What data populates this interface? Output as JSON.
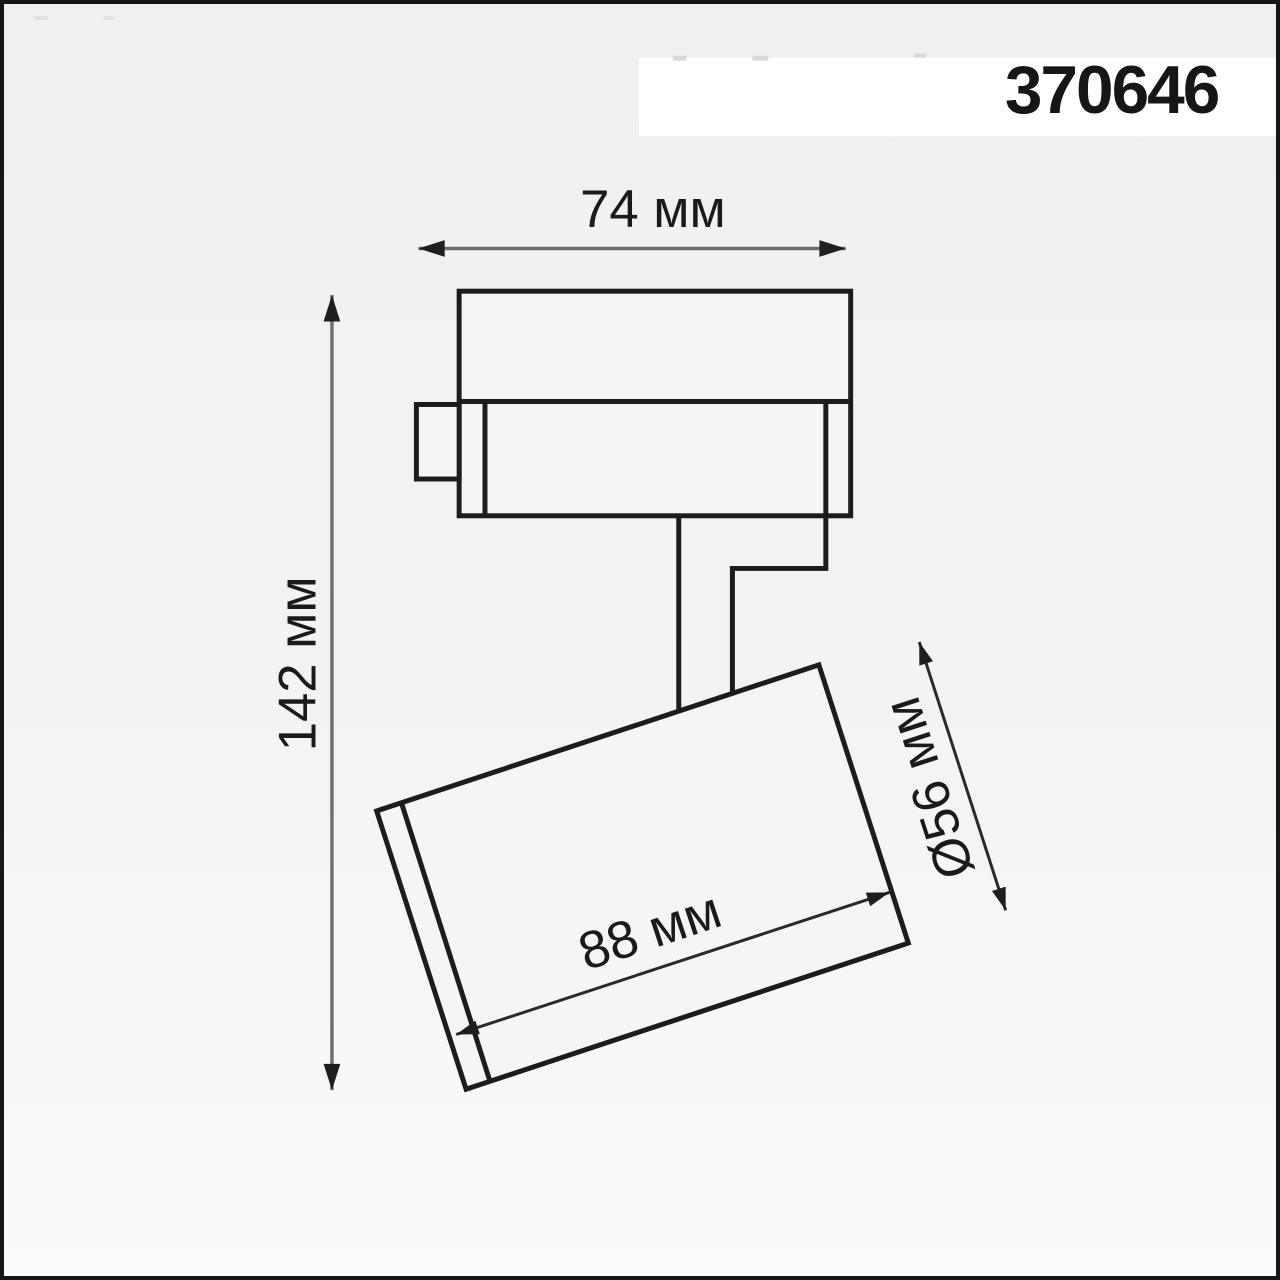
{
  "product": {
    "code": "370646"
  },
  "dimensions": {
    "track_width": {
      "value": 74,
      "unit": "мм",
      "label": "74 мм"
    },
    "total_height": {
      "value": 142,
      "unit": "мм",
      "label": "142 мм"
    },
    "head_length": {
      "value": 88,
      "unit": "мм",
      "label": "88 мм"
    },
    "head_diameter": {
      "value": 56,
      "unit": "мм",
      "label": "Ø56 мм"
    }
  },
  "colors": {
    "background_top": "#f0f0f0",
    "background_bottom": "#fbfbfb",
    "band": "#ffffff",
    "frame": "#161616",
    "outline": "#1c1c1c",
    "dimension_line_gray": "#6f6f6f",
    "dimension_line_dark": "#2a2a2a",
    "text": "#1a1a1a"
  }
}
